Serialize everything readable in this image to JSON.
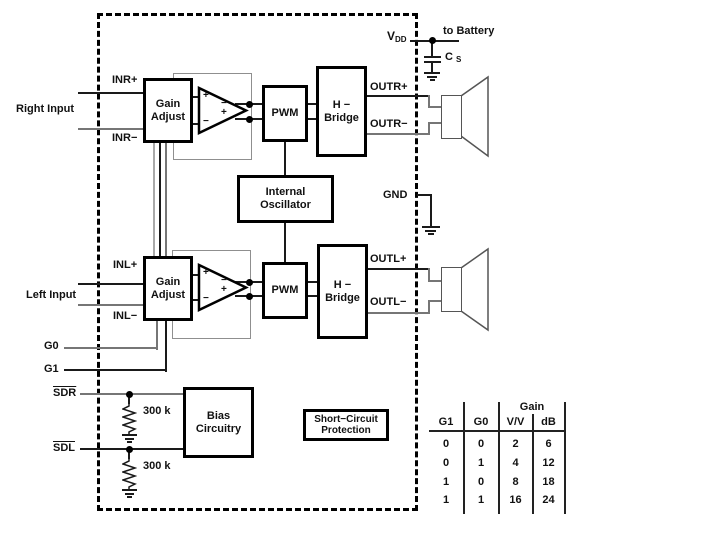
{
  "ic": {
    "power": {
      "vdd_main": "V",
      "vdd_sub": "DD",
      "to_battery": "to Battery",
      "cap_main": "C",
      "cap_sub": "S",
      "gnd": "GND"
    },
    "right_channel": {
      "in_plus": "INR+",
      "in_minus": "INR−",
      "input_label": "Right Input",
      "out_plus": "OUTR+",
      "out_minus": "OUTR−"
    },
    "left_channel": {
      "in_plus": "INL+",
      "in_minus": "INL−",
      "input_label": "Left Input",
      "out_plus": "OUTL+",
      "out_minus": "OUTL−"
    },
    "gain_pins": {
      "g0": "G0",
      "g1": "G1"
    },
    "shutdown_pins": {
      "sdr": "SDR",
      "sdl": "SDL",
      "r_sdr": "300 k",
      "r_sdl": "300 k"
    },
    "blocks": {
      "gain_adjust_right": "Gain\nAdjust",
      "gain_adjust_left": "Gain\nAdjust",
      "pwm_right": "PWM",
      "pwm_left": "PWM",
      "h_bridge_right": "H −\nBridge",
      "h_bridge_left": "H −\nBridge",
      "internal_oscillator": "Internal\nOscillator",
      "bias_circuitry": "Bias\nCircuitry",
      "short_circuit_protection": "Short−Circuit\nProtection"
    },
    "opamp_marks": {
      "plus": "+",
      "minus": "−"
    }
  },
  "gain_table": {
    "span_header": "Gain",
    "col_headers": [
      "G1",
      "G0",
      "V/V",
      "dB"
    ],
    "rows": [
      [
        "0",
        "0",
        "2",
        "6"
      ],
      [
        "0",
        "1",
        "4",
        "12"
      ],
      [
        "1",
        "0",
        "8",
        "18"
      ],
      [
        "1",
        "1",
        "16",
        "24"
      ]
    ]
  }
}
